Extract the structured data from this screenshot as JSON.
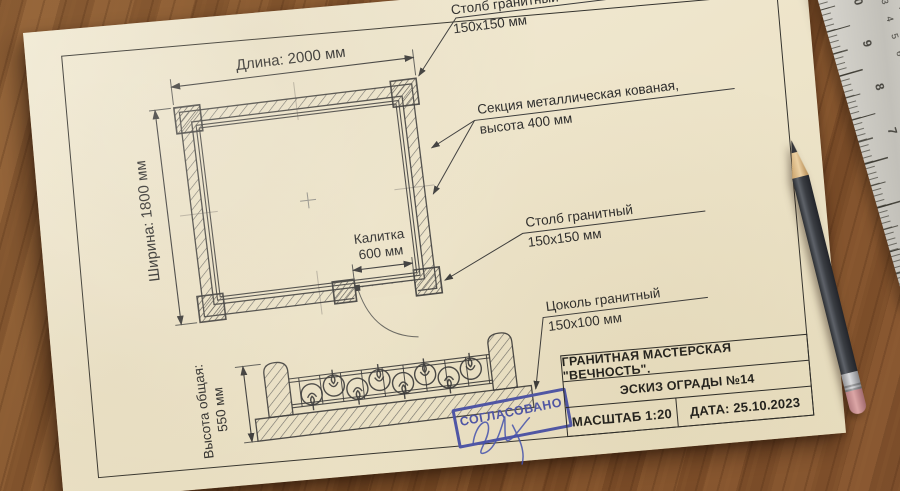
{
  "sheet": {
    "labels": {
      "length": "Длина: 2000 мм",
      "width": "Ширина: 1800 мм",
      "gate_line1": "Калитка",
      "gate_line2": "600 мм",
      "post_top_line1": "Столб гранитный",
      "post_top_line2": "150x150 мм",
      "section_line1": "Секция металлическая кованая,",
      "section_line2": "высота 400 мм",
      "post_gate_line1": "Столб гранитный",
      "post_gate_line2": "150x150 мм",
      "plinth_line1": "Цоколь гранитный",
      "plinth_line2": "150x100 мм",
      "height_line1": "Высота общая:",
      "height_line2": "550 мм"
    },
    "title_block": {
      "company": "ГРАНИТНАЯ МАСТЕРСКАЯ \"ВЕЧНОСТЬ\".",
      "sketch": "ЭСКИЗ ОГРАДЫ №14",
      "scale": "МАСШТАБ 1:20",
      "date": "ДАТА: 25.10.2023"
    },
    "stamp": {
      "text": "СОГЛАСОВАНО"
    }
  },
  "ruler": {
    "inch_numbers": [
      "10",
      "9",
      "8",
      "7",
      "6",
      "5",
      "4"
    ],
    "cm_numbers": [
      "1",
      "2",
      "3",
      "4",
      "5",
      "6",
      "7",
      "8",
      "9",
      "10",
      "11",
      "12",
      "13",
      "14",
      "15",
      "16"
    ]
  },
  "colors": {
    "stamp_blue": "#4d55a8",
    "paper": "#efe6cc",
    "ink": "#3a3a3a",
    "wood": "#8c5c36",
    "ruler_metal": "#cfccc4",
    "pencil_body": "#3a3d41",
    "eraser_pink": "#c9898d"
  }
}
